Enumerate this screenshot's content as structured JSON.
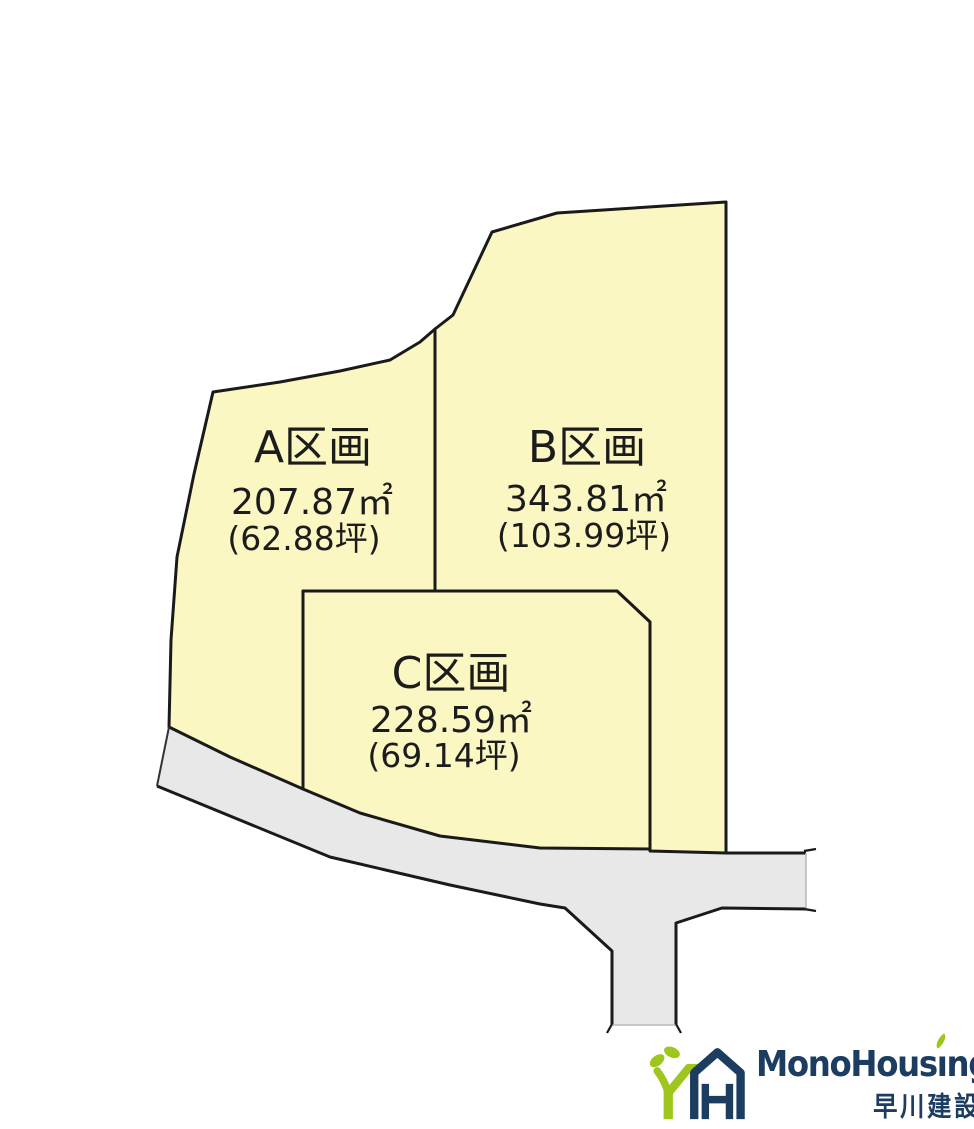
{
  "diagram": {
    "parcels": [
      {
        "id": "A",
        "label": "A区画",
        "area_sqm": "207.87㎡",
        "area_tsubo": "(62.88坪)",
        "fill": "#faf7c3"
      },
      {
        "id": "B",
        "label": "B区画",
        "area_sqm": "343.81㎡",
        "area_tsubo": "(103.99坪)",
        "fill": "#faf7c3"
      },
      {
        "id": "C",
        "label": "C区画",
        "area_sqm": "228.59㎡",
        "area_tsubo": "(69.14坪)",
        "fill": "#faf7c3"
      }
    ],
    "road_color": "#e8e8e9",
    "outline_color": "#1a1a1a"
  },
  "logo": {
    "brand_full": "MonoHousing",
    "brand_pre": "MonoHous",
    "brand_i": "ı",
    "brand_post": "ng",
    "company": "早川建設",
    "brand_color": "#1c3d60",
    "accent_green": "#9ec61c"
  }
}
